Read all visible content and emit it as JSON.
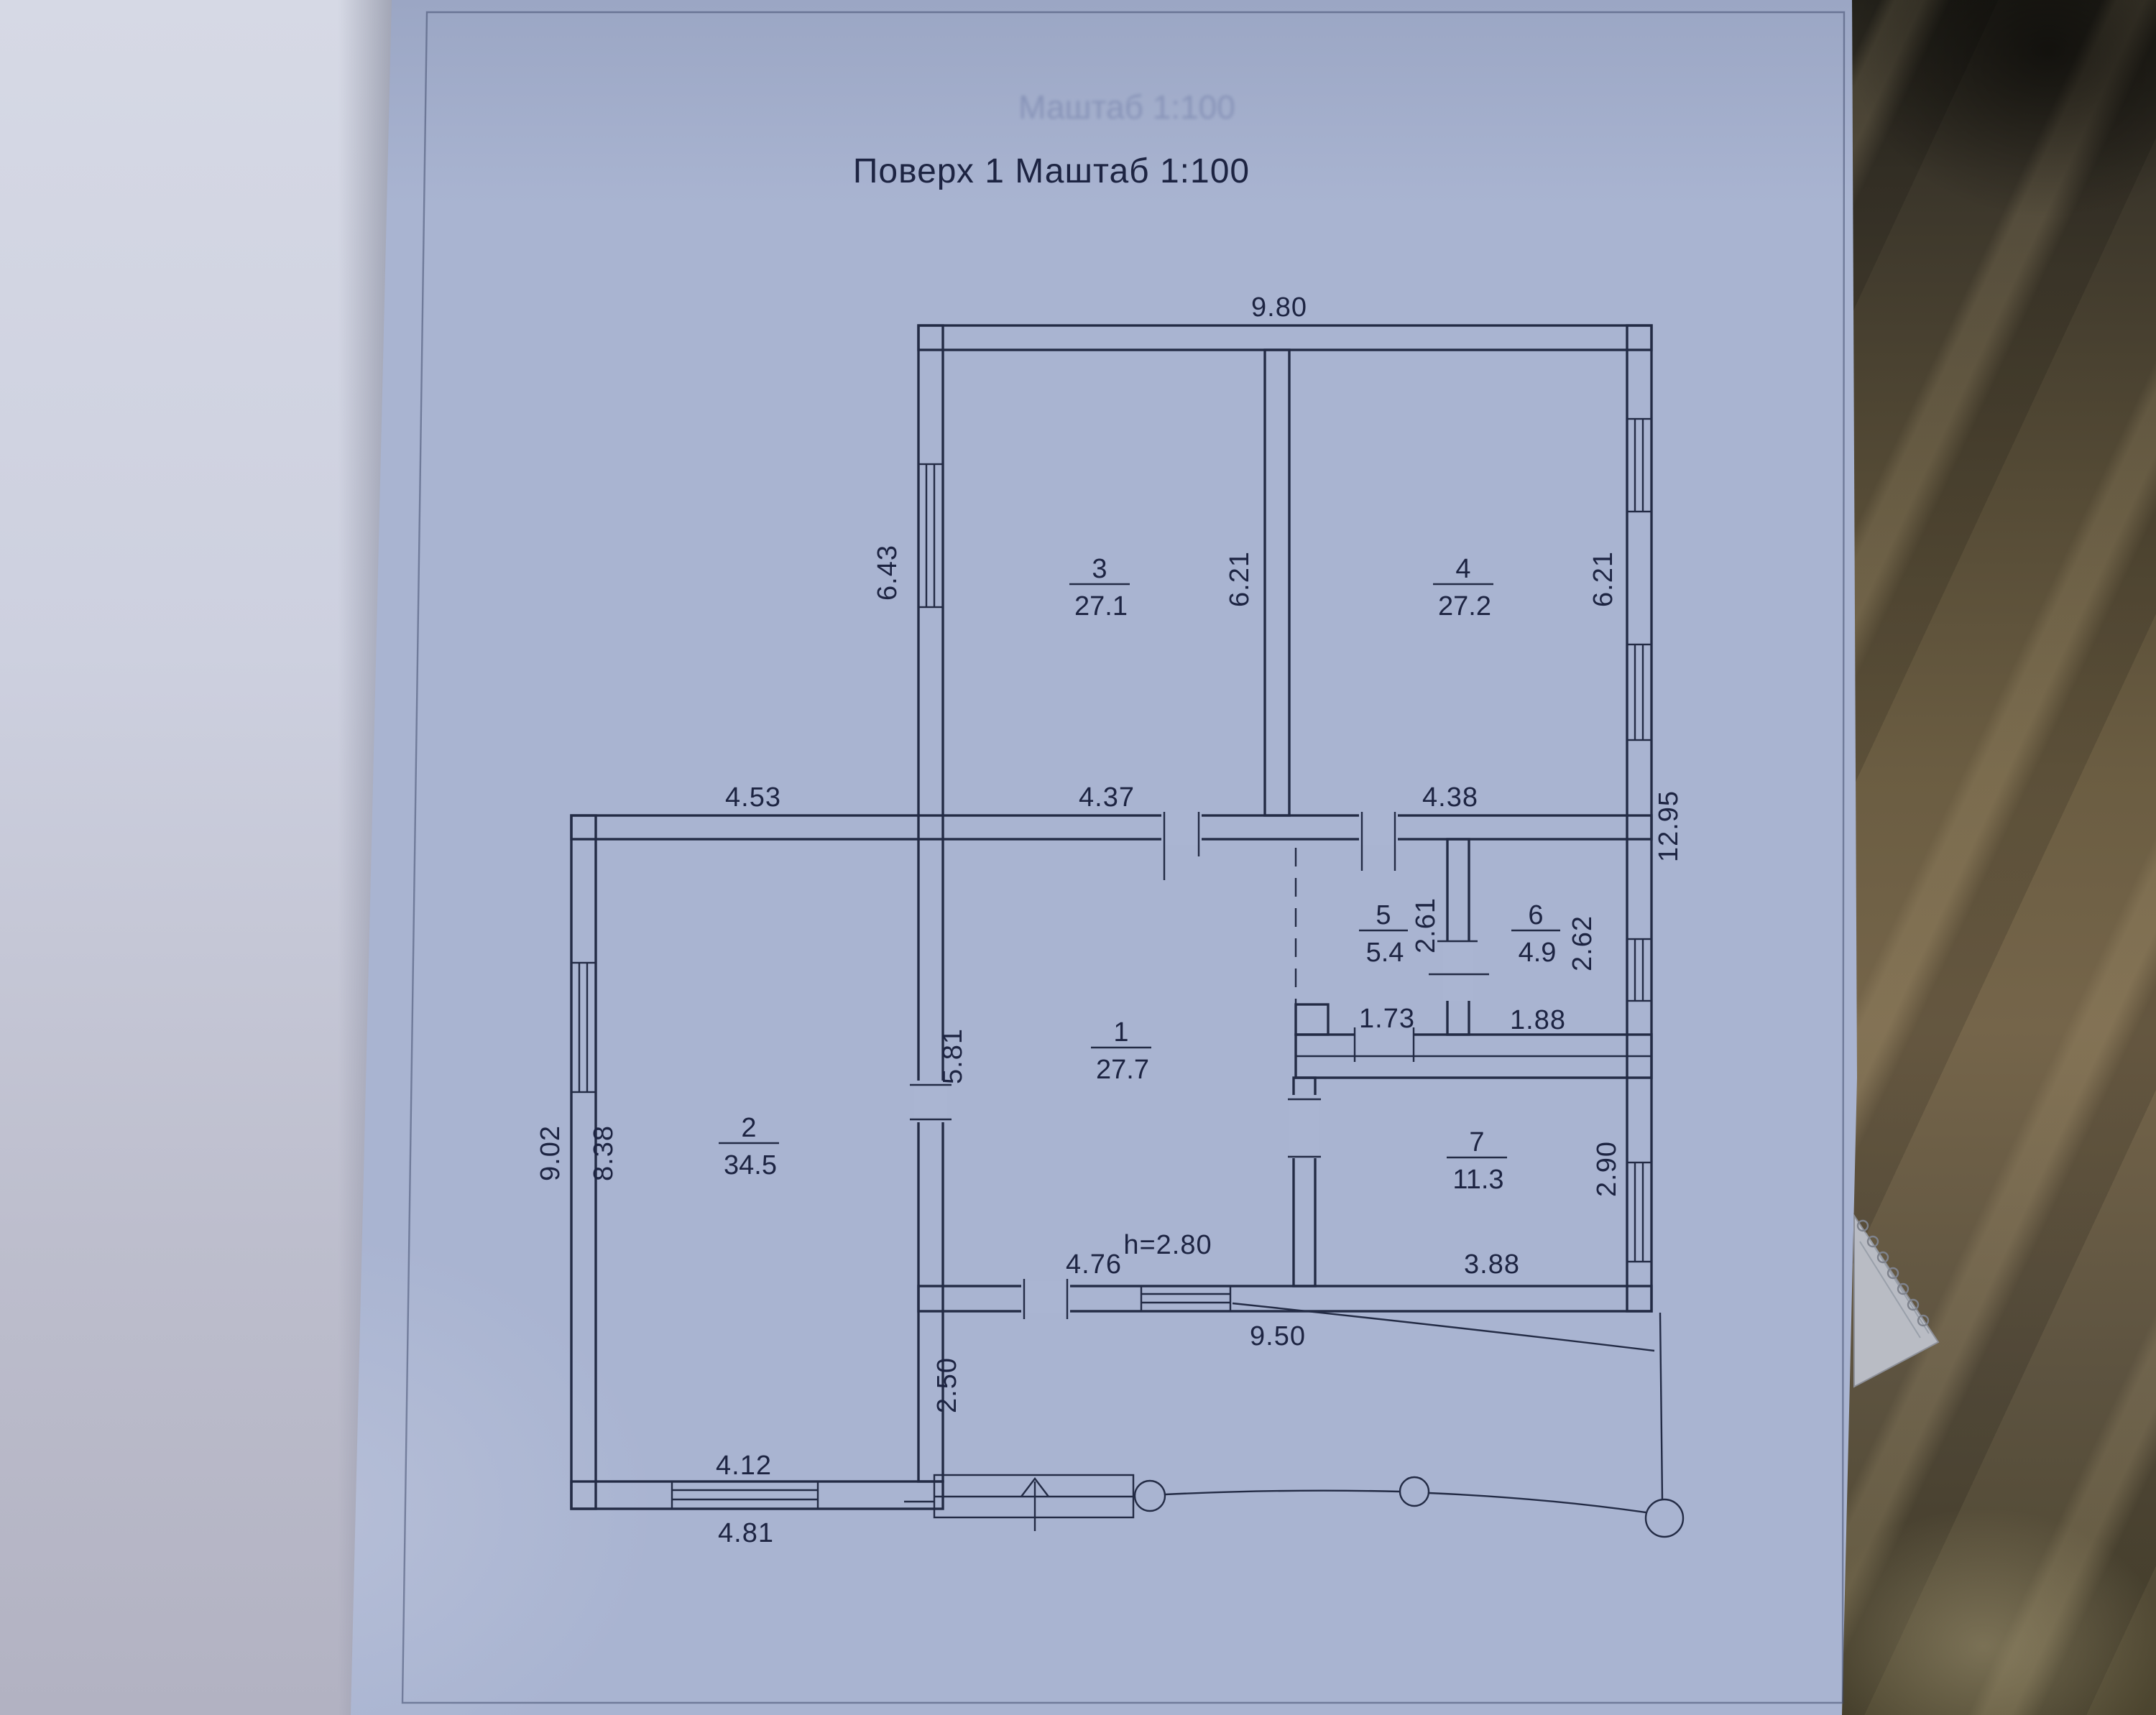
{
  "plan": {
    "title": "Поверх 1 Маштаб 1:100",
    "ghost_text": "Маштаб 1:100",
    "rooms": [
      {
        "num": "1",
        "area": "27.7"
      },
      {
        "num": "2",
        "area": "34.5"
      },
      {
        "num": "3",
        "area": "27.1"
      },
      {
        "num": "4",
        "area": "27.2"
      },
      {
        "num": "5",
        "area": "5.4"
      },
      {
        "num": "6",
        "area": "4.9"
      },
      {
        "num": "7",
        "area": "11.3"
      }
    ],
    "dims": {
      "top_width": "9.80",
      "left_upper": "6.43",
      "room3_depth": "6.21",
      "room4_depth": "6.21",
      "mid_left": "4.53",
      "room1_width": "4.37",
      "mid_right": "4.38",
      "right_total": "12.95",
      "room5_depth": "2.61",
      "room6_depth": "2.62",
      "room5_width": "1.73",
      "room6_width": "1.88",
      "room1_depth": "5.81",
      "left_outer": "9.02",
      "room2_depth": "8.38",
      "room1_bottom": "4.76",
      "ceiling_height": "h=2.80",
      "room7_width": "3.88",
      "room7_depth": "2.90",
      "terrace_width": "9.50",
      "porch_depth": "2.50",
      "room2_bottom_inner": "4.12",
      "room2_bottom_outer": "4.81"
    }
  },
  "palette": {
    "page_blue": "#a9b4d1",
    "ink": "#1d2442",
    "dirt_brown": "#5d5340",
    "prev_page": "#cdd0df",
    "torn_paper": "#b9bcc4"
  }
}
